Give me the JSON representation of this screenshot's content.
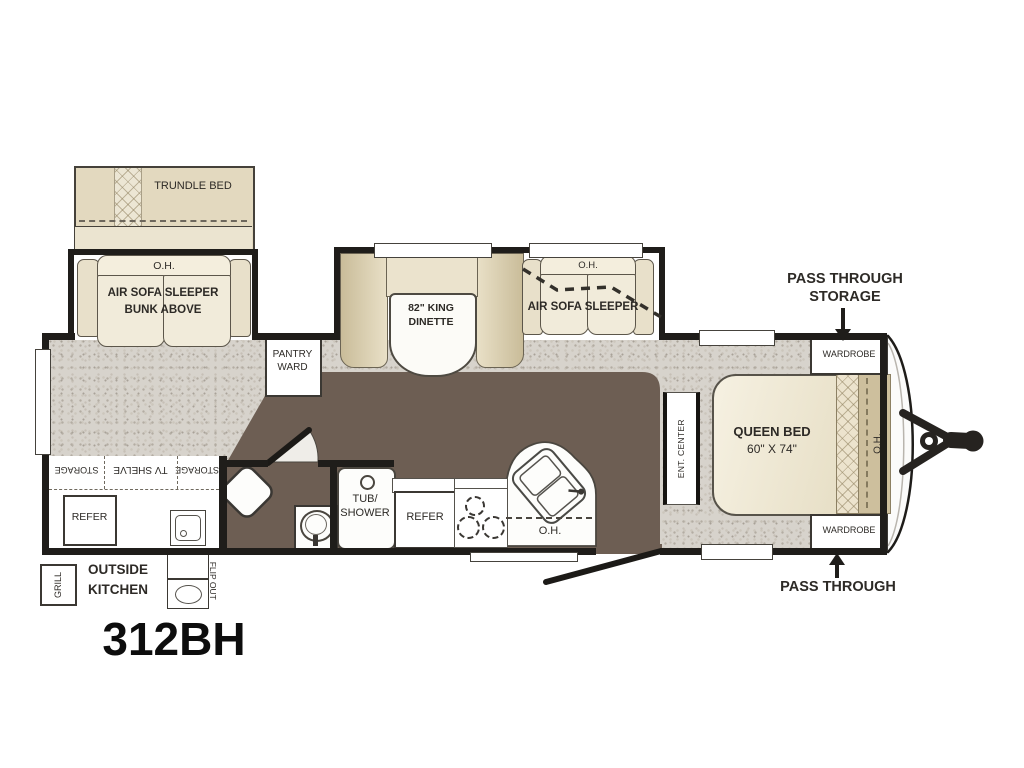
{
  "title": "312BH",
  "colors": {
    "wall": "#1f1d1a",
    "carpet": "#d7d3cc",
    "floor_vinyl_brown": "#6d5e53",
    "furniture_tan": "#e0d5b8",
    "cushion_cream": "#f1ebda",
    "label_text": "#2d2a26"
  },
  "labels": {
    "trundle_bed": "TRUNDLE BED",
    "bunk_oh": "O.H.",
    "bunk_line1": "AIR SOFA SLEEPER",
    "bunk_line2": "BUNK ABOVE",
    "pantry_line1": "PANTRY",
    "pantry_line2": "WARD",
    "dinette_line1": "82\" KING",
    "dinette_line2": "DINETTE",
    "sofa_oh": "O.H.",
    "sofa": "AIR SOFA SLEEPER",
    "pts_line1": "PASS THROUGH",
    "pts_line2": "STORAGE",
    "wardrobe_top": "WARDROBE",
    "wardrobe_bottom": "WARDROBE",
    "queen_line1": "QUEEN BED",
    "queen_line2": "60\" X 74\"",
    "bed_oh": "O.H.",
    "ent_center": "ENT. CENTER",
    "pass_through": "PASS THROUGH",
    "tub_line1": "TUB/",
    "tub_line2": "SHOWER",
    "kitchen_refer": "REFER",
    "kitchen_oh": "O.H.",
    "storage_a": "STORAGE",
    "tv_shelve": "TV SHELVE",
    "storage_b": "STORAGE",
    "tv_refer": "REFER",
    "outside_line1": "OUTSIDE",
    "outside_line2": "KITCHEN",
    "grill": "GRILL",
    "flip_out": "FLIP OUT"
  }
}
